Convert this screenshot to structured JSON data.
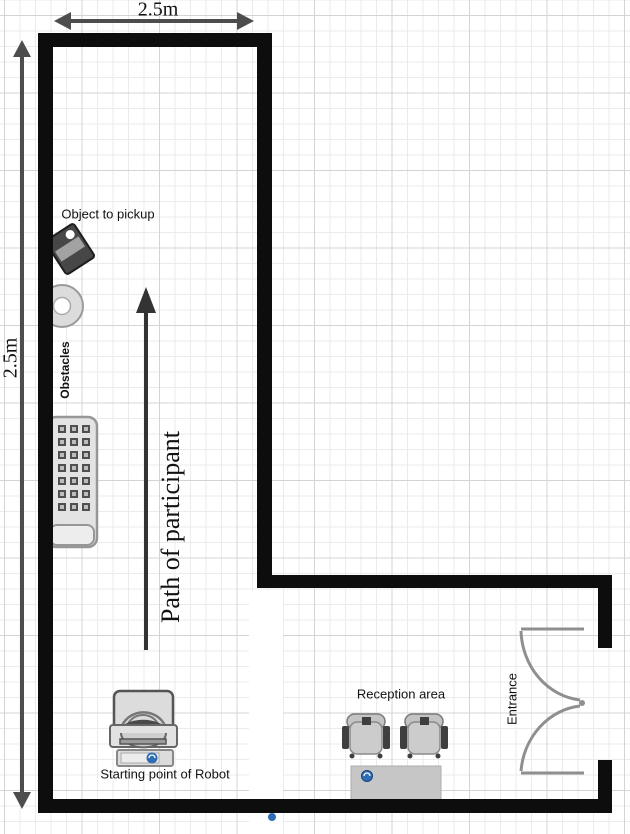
{
  "diagram": {
    "title": "Experiment room floor plan",
    "dimensions": {
      "top": "2.5m",
      "left": "2.5m"
    },
    "labels": {
      "object_pickup": "Object to pickup",
      "obstacles": "Obstacles",
      "path": "Path of participant",
      "robot_start": "Starting point of Robot",
      "reception": "Reception area",
      "entrance": "Entrance"
    },
    "icons": {
      "object-pickup-icon": "small dark tilted box (floppy-like object)",
      "donut-obstacle-icon": "ring / washer shaped obstacle",
      "radiator-obstacle-icon": "crate with 3x7 grid of squares",
      "robot-icon": "robot (scanner-like clipart) with blue badge",
      "chair-icon": "top-view chair with armrests",
      "reception-table": "gray rectangular desk with blue badge",
      "entrance-door-icon": "double swing doors",
      "path-arrow": "upward arrow",
      "dimension-arrow": "double-headed measuring arrow"
    },
    "colors": {
      "wall": "#0d0d0d",
      "grid_minor": "#ebebeb",
      "grid_major": "#d4d4d4",
      "dimension_arrow": "#4d4d4d",
      "path_arrow": "#333333",
      "object_fill": "#d9d9d9",
      "object_border": "#8f8f8f",
      "door": "#8f8f8f",
      "accent_blue": "#2e6cb4"
    }
  }
}
